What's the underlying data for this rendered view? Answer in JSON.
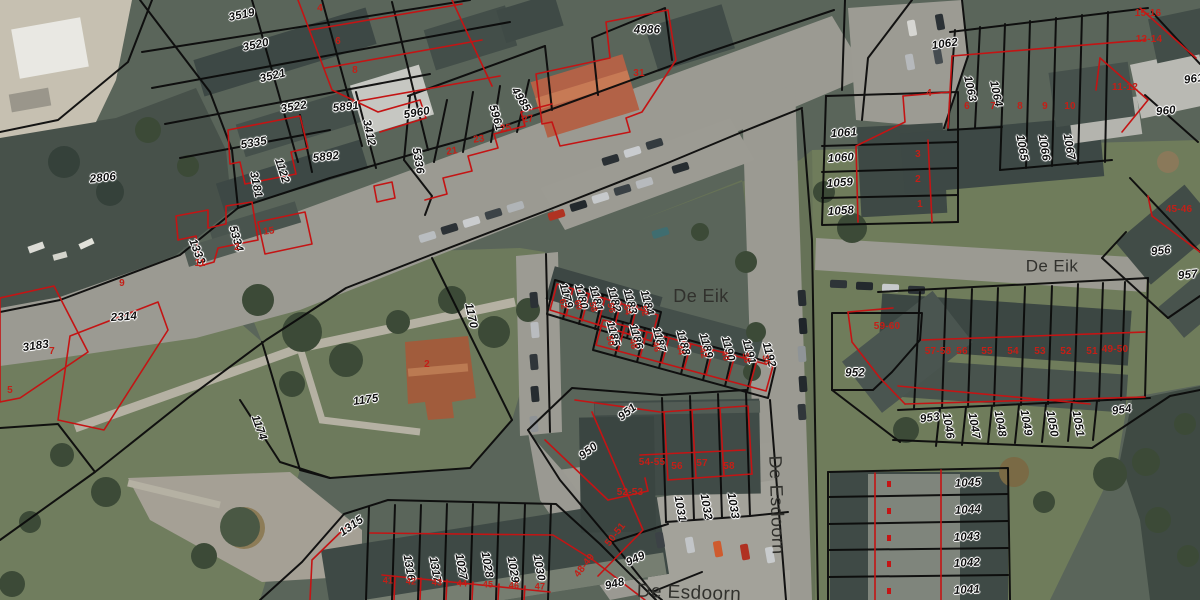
{
  "map": {
    "colors": {
      "parcel_text": "#101010",
      "house_number_text": "#c41f17",
      "street_text": "#31312d",
      "black_boundary_line": "#0b0b0b",
      "red_boundary_line": "#c41414"
    },
    "streets": [
      {
        "t": "De Eik",
        "x": 701,
        "y": 296,
        "r": 0,
        "s": 18
      },
      {
        "t": "De Eik",
        "x": 1052,
        "y": 266,
        "r": 0,
        "s": 17
      },
      {
        "t": "De Esdoorn",
        "x": 777,
        "y": 505,
        "r": 88,
        "s": 18
      },
      {
        "t": "De Esdoorn",
        "x": 689,
        "y": 593,
        "r": 2,
        "s": 19
      }
    ],
    "parcels": [
      {
        "t": "3519",
        "x": 242,
        "y": 16,
        "r": -12
      },
      {
        "t": "3520",
        "x": 256,
        "y": 46,
        "r": -12
      },
      {
        "t": "3521",
        "x": 273,
        "y": 77,
        "r": -14
      },
      {
        "t": "3522",
        "x": 294,
        "y": 108,
        "r": -10
      },
      {
        "t": "5891",
        "x": 346,
        "y": 108,
        "r": -6
      },
      {
        "t": "3412",
        "x": 368,
        "y": 133,
        "r": 78
      },
      {
        "t": "5335",
        "x": 254,
        "y": 144,
        "r": -10
      },
      {
        "t": "5892",
        "x": 326,
        "y": 158,
        "r": -6
      },
      {
        "t": "5960",
        "x": 417,
        "y": 114,
        "r": -10
      },
      {
        "t": "5961",
        "x": 495,
        "y": 118,
        "r": 74
      },
      {
        "t": "4985",
        "x": 520,
        "y": 100,
        "r": 58
      },
      {
        "t": "4986",
        "x": 647,
        "y": 31,
        "r": 0
      },
      {
        "t": "5336",
        "x": 417,
        "y": 161,
        "r": 80
      },
      {
        "t": "2806",
        "x": 103,
        "y": 179,
        "r": -6
      },
      {
        "t": "1122",
        "x": 281,
        "y": 171,
        "r": 72
      },
      {
        "t": "3181",
        "x": 255,
        "y": 185,
        "r": 78
      },
      {
        "t": "5334",
        "x": 235,
        "y": 239,
        "r": 74
      },
      {
        "t": "1333",
        "x": 196,
        "y": 252,
        "r": 68
      },
      {
        "t": "3183",
        "x": 36,
        "y": 347,
        "r": -8
      },
      {
        "t": "2314",
        "x": 124,
        "y": 318,
        "r": -4
      },
      {
        "t": "1170",
        "x": 470,
        "y": 316,
        "r": 78
      },
      {
        "t": "1175",
        "x": 366,
        "y": 401,
        "r": -8
      },
      {
        "t": "1174",
        "x": 258,
        "y": 428,
        "r": 70
      },
      {
        "t": "1315",
        "x": 352,
        "y": 527,
        "r": -35
      },
      {
        "t": "1316",
        "x": 408,
        "y": 568,
        "r": 80
      },
      {
        "t": "1317",
        "x": 434,
        "y": 570,
        "r": 80
      },
      {
        "t": "1027",
        "x": 460,
        "y": 567,
        "r": 80
      },
      {
        "t": "1028",
        "x": 486,
        "y": 565,
        "r": 80
      },
      {
        "t": "1029",
        "x": 512,
        "y": 570,
        "r": 80
      },
      {
        "t": "1030",
        "x": 538,
        "y": 568,
        "r": 80
      },
      {
        "t": "951",
        "x": 628,
        "y": 413,
        "r": -38
      },
      {
        "t": "950",
        "x": 589,
        "y": 452,
        "r": -38
      },
      {
        "t": "949",
        "x": 636,
        "y": 560,
        "r": -25
      },
      {
        "t": "948",
        "x": 615,
        "y": 585,
        "r": -14
      },
      {
        "t": "1031",
        "x": 679,
        "y": 509,
        "r": 80
      },
      {
        "t": "1032",
        "x": 705,
        "y": 507,
        "r": 80
      },
      {
        "t": "1033",
        "x": 732,
        "y": 506,
        "r": 80
      },
      {
        "t": "1179",
        "x": 565,
        "y": 296,
        "r": 75
      },
      {
        "t": "1180",
        "x": 580,
        "y": 297,
        "r": 75
      },
      {
        "t": "1181",
        "x": 595,
        "y": 299,
        "r": 75
      },
      {
        "t": "1182",
        "x": 613,
        "y": 300,
        "r": 75
      },
      {
        "t": "1183",
        "x": 629,
        "y": 302,
        "r": 75
      },
      {
        "t": "1184",
        "x": 646,
        "y": 303,
        "r": 75
      },
      {
        "t": "1185",
        "x": 612,
        "y": 334,
        "r": 75
      },
      {
        "t": "1186",
        "x": 635,
        "y": 337,
        "r": 75
      },
      {
        "t": "1187",
        "x": 658,
        "y": 340,
        "r": 75
      },
      {
        "t": "1188",
        "x": 682,
        "y": 343,
        "r": 75
      },
      {
        "t": "1189",
        "x": 705,
        "y": 346,
        "r": 75
      },
      {
        "t": "1190",
        "x": 727,
        "y": 349,
        "r": 75
      },
      {
        "t": "1191",
        "x": 748,
        "y": 352,
        "r": 75
      },
      {
        "t": "1192",
        "x": 768,
        "y": 355,
        "r": 75
      },
      {
        "t": "1062",
        "x": 945,
        "y": 45,
        "r": -8
      },
      {
        "t": "1063",
        "x": 969,
        "y": 89,
        "r": 78
      },
      {
        "t": "1064",
        "x": 995,
        "y": 94,
        "r": 78
      },
      {
        "t": "1065",
        "x": 1021,
        "y": 148,
        "r": 80
      },
      {
        "t": "1066",
        "x": 1043,
        "y": 148,
        "r": 80
      },
      {
        "t": "1067",
        "x": 1068,
        "y": 147,
        "r": 80
      },
      {
        "t": "1061",
        "x": 844,
        "y": 134,
        "r": -4
      },
      {
        "t": "1060",
        "x": 841,
        "y": 159,
        "r": -4
      },
      {
        "t": "1059",
        "x": 840,
        "y": 184,
        "r": -4
      },
      {
        "t": "1058",
        "x": 841,
        "y": 212,
        "r": -4
      },
      {
        "t": "960",
        "x": 1166,
        "y": 112,
        "r": -6
      },
      {
        "t": "961",
        "x": 1194,
        "y": 80,
        "r": -8
      },
      {
        "t": "956",
        "x": 1161,
        "y": 252,
        "r": -6
      },
      {
        "t": "957",
        "x": 1188,
        "y": 276,
        "r": -6
      },
      {
        "t": "952",
        "x": 855,
        "y": 374,
        "r": 0
      },
      {
        "t": "953",
        "x": 930,
        "y": 419,
        "r": -8
      },
      {
        "t": "954",
        "x": 1122,
        "y": 411,
        "r": -8
      },
      {
        "t": "1046",
        "x": 947,
        "y": 426,
        "r": 80
      },
      {
        "t": "1047",
        "x": 973,
        "y": 426,
        "r": 80
      },
      {
        "t": "1048",
        "x": 999,
        "y": 424,
        "r": 80
      },
      {
        "t": "1049",
        "x": 1025,
        "y": 423,
        "r": 80
      },
      {
        "t": "1050",
        "x": 1051,
        "y": 424,
        "r": 80
      },
      {
        "t": "1051",
        "x": 1077,
        "y": 424,
        "r": 80
      },
      {
        "t": "1045",
        "x": 968,
        "y": 484,
        "r": -3
      },
      {
        "t": "1044",
        "x": 968,
        "y": 511,
        "r": -3
      },
      {
        "t": "1043",
        "x": 967,
        "y": 538,
        "r": -3
      },
      {
        "t": "1042",
        "x": 967,
        "y": 564,
        "r": -3
      },
      {
        "t": "1041",
        "x": 967,
        "y": 591,
        "r": -3
      }
    ],
    "house_numbers": [
      {
        "t": "4",
        "x": 320,
        "y": 9,
        "r": 0
      },
      {
        "t": "6",
        "x": 338,
        "y": 42,
        "r": 0
      },
      {
        "t": "8",
        "x": 355,
        "y": 71,
        "r": 0
      },
      {
        "t": "31",
        "x": 639,
        "y": 74,
        "r": 0
      },
      {
        "t": "27",
        "x": 528,
        "y": 120,
        "r": -8
      },
      {
        "t": "25",
        "x": 506,
        "y": 129,
        "r": -8
      },
      {
        "t": "23",
        "x": 479,
        "y": 140,
        "r": -8
      },
      {
        "t": "21",
        "x": 452,
        "y": 152,
        "r": -8
      },
      {
        "t": "15",
        "x": 269,
        "y": 232,
        "r": -8
      },
      {
        "t": "11",
        "x": 200,
        "y": 264,
        "r": 0
      },
      {
        "t": "2",
        "x": 237,
        "y": 248,
        "r": 0
      },
      {
        "t": "9",
        "x": 122,
        "y": 284,
        "r": 0
      },
      {
        "t": "7",
        "x": 52,
        "y": 352,
        "r": 0
      },
      {
        "t": "5",
        "x": 10,
        "y": 391,
        "r": 0
      },
      {
        "t": "2",
        "x": 427,
        "y": 365,
        "r": 0
      },
      {
        "t": "59-60",
        "x": 887,
        "y": 327,
        "r": 0
      },
      {
        "t": "57-58",
        "x": 938,
        "y": 352,
        "r": 0
      },
      {
        "t": "56",
        "x": 962,
        "y": 352,
        "r": 0
      },
      {
        "t": "55",
        "x": 987,
        "y": 352,
        "r": 0
      },
      {
        "t": "54",
        "x": 1013,
        "y": 352,
        "r": 0
      },
      {
        "t": "53",
        "x": 1040,
        "y": 352,
        "r": 0
      },
      {
        "t": "52",
        "x": 1066,
        "y": 352,
        "r": 0
      },
      {
        "t": "51",
        "x": 1092,
        "y": 352,
        "r": 0
      },
      {
        "t": "49-50",
        "x": 1115,
        "y": 350,
        "r": 0
      },
      {
        "t": "45-46",
        "x": 1179,
        "y": 210,
        "r": 0
      },
      {
        "t": "15-16",
        "x": 1148,
        "y": 14,
        "r": 0
      },
      {
        "t": "13-14",
        "x": 1149,
        "y": 40,
        "r": 0
      },
      {
        "t": "11-12",
        "x": 1125,
        "y": 88,
        "r": 0
      },
      {
        "t": "6",
        "x": 967,
        "y": 107,
        "r": 0
      },
      {
        "t": "7",
        "x": 993,
        "y": 107,
        "r": 0
      },
      {
        "t": "8",
        "x": 1020,
        "y": 107,
        "r": 0
      },
      {
        "t": "9",
        "x": 1045,
        "y": 107,
        "r": 0
      },
      {
        "t": "10",
        "x": 1070,
        "y": 107,
        "r": 0
      },
      {
        "t": "4",
        "x": 929,
        "y": 94,
        "r": 0
      },
      {
        "t": "3",
        "x": 918,
        "y": 155,
        "r": 0
      },
      {
        "t": "2",
        "x": 918,
        "y": 180,
        "r": 0
      },
      {
        "t": "1",
        "x": 920,
        "y": 205,
        "r": 0
      },
      {
        "t": "54-55",
        "x": 652,
        "y": 463,
        "r": 0
      },
      {
        "t": "56",
        "x": 677,
        "y": 467,
        "r": 0
      },
      {
        "t": "57",
        "x": 702,
        "y": 464,
        "r": 0
      },
      {
        "t": "58",
        "x": 729,
        "y": 467,
        "r": 0
      },
      {
        "t": "52-53",
        "x": 630,
        "y": 493,
        "r": 0
      },
      {
        "t": "50-51",
        "x": 616,
        "y": 535,
        "r": -52
      },
      {
        "t": "48-49",
        "x": 585,
        "y": 566,
        "r": -52
      },
      {
        "t": "41",
        "x": 388,
        "y": 581,
        "r": 0,
        "s": 9
      },
      {
        "t": "42",
        "x": 411,
        "y": 582,
        "r": 0,
        "s": 9
      },
      {
        "t": "43",
        "x": 437,
        "y": 583,
        "r": 0,
        "s": 9
      },
      {
        "t": "44",
        "x": 462,
        "y": 584,
        "r": 0,
        "s": 9
      },
      {
        "t": "45",
        "x": 488,
        "y": 585,
        "r": 0,
        "s": 9
      },
      {
        "t": "46",
        "x": 514,
        "y": 586,
        "r": 0,
        "s": 9
      },
      {
        "t": "47",
        "x": 540,
        "y": 587,
        "r": 0,
        "s": 9
      },
      {
        "t": "62",
        "x": 563,
        "y": 304,
        "r": 75,
        "s": 9
      },
      {
        "t": "60",
        "x": 578,
        "y": 305,
        "r": 75,
        "s": 9
      },
      {
        "t": "58",
        "x": 593,
        "y": 307,
        "r": 75,
        "s": 9
      },
      {
        "t": "56",
        "x": 611,
        "y": 308,
        "r": 75,
        "s": 9
      },
      {
        "t": "54",
        "x": 627,
        "y": 310,
        "r": 75,
        "s": 9
      },
      {
        "t": "52",
        "x": 644,
        "y": 311,
        "r": 75,
        "s": 9
      },
      {
        "t": "50",
        "x": 610,
        "y": 341,
        "r": 75,
        "s": 9
      },
      {
        "t": "48",
        "x": 633,
        "y": 344,
        "r": 75,
        "s": 9
      },
      {
        "t": "46",
        "x": 656,
        "y": 347,
        "r": 75,
        "s": 9
      },
      {
        "t": "44",
        "x": 680,
        "y": 350,
        "r": 75,
        "s": 9
      },
      {
        "t": "42",
        "x": 703,
        "y": 353,
        "r": 75,
        "s": 9
      },
      {
        "t": "40",
        "x": 725,
        "y": 356,
        "r": 75,
        "s": 9
      },
      {
        "t": "38",
        "x": 746,
        "y": 358,
        "r": 75,
        "s": 9
      },
      {
        "t": "36",
        "x": 766,
        "y": 360,
        "r": 75,
        "s": 9
      }
    ]
  }
}
